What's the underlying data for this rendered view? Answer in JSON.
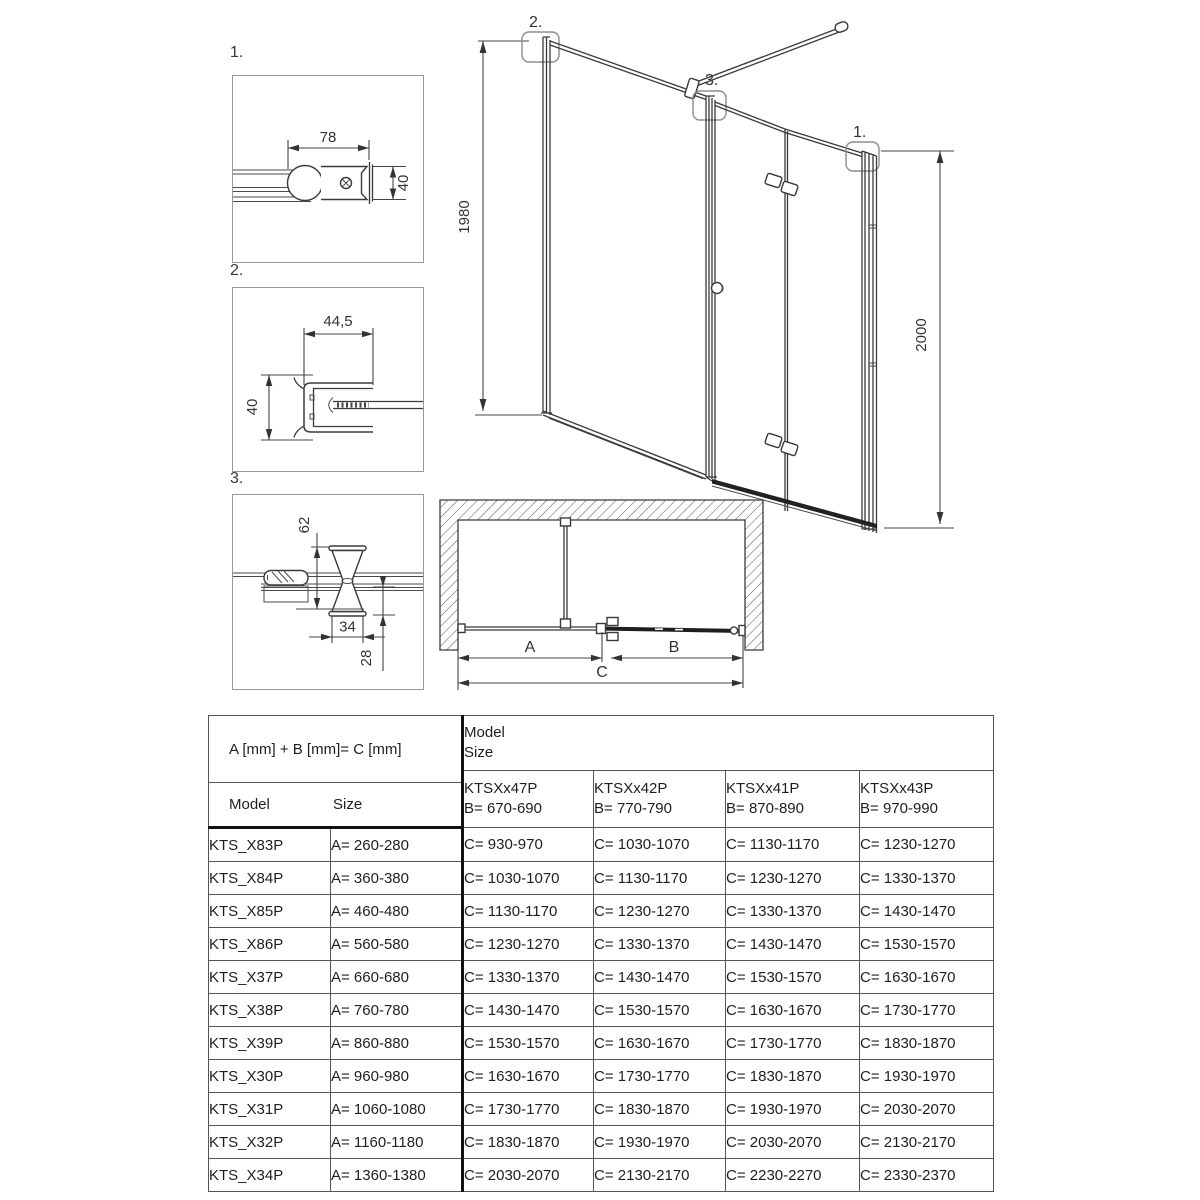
{
  "details": [
    {
      "label": "1.",
      "dim_width": "78",
      "dim_height": "40"
    },
    {
      "label": "2.",
      "dim_width": "44,5",
      "dim_height": "40"
    },
    {
      "label": "3.",
      "dim_top": "62",
      "dim_width": "34",
      "dim_bottom": "28"
    }
  ],
  "elevation": {
    "callout_wall_profile": "2.",
    "callout_center_profile": "3.",
    "callout_right_profile": "1.",
    "dim_height_left": "1980",
    "dim_height_right": "2000"
  },
  "plan": {
    "dim_a": "A",
    "dim_b": "B",
    "dim_c": "C"
  },
  "table": {
    "formula": "A [mm] + B [mm]= C [mm]",
    "col_model": "Model",
    "col_size": "Size",
    "group_line1": "Model",
    "group_line2": "Size",
    "columns": [
      {
        "name": "KTSXx47P",
        "b": "B= 670-690"
      },
      {
        "name": "KTSXx42P",
        "b": "B= 770-790"
      },
      {
        "name": "KTSXx41P",
        "b": "B= 870-890"
      },
      {
        "name": "KTSXx43P",
        "b": "B= 970-990"
      }
    ],
    "rows": [
      {
        "model": "KTS_X83P",
        "a": "A= 260-280",
        "c": [
          "C= 930-970",
          "C= 1030-1070",
          "C= 1130-1170",
          "C= 1230-1270"
        ]
      },
      {
        "model": "KTS_X84P",
        "a": "A= 360-380",
        "c": [
          "C= 1030-1070",
          "C= 1130-1170",
          "C= 1230-1270",
          "C= 1330-1370"
        ]
      },
      {
        "model": "KTS_X85P",
        "a": "A= 460-480",
        "c": [
          "C= 1130-1170",
          "C= 1230-1270",
          "C= 1330-1370",
          "C= 1430-1470"
        ]
      },
      {
        "model": "KTS_X86P",
        "a": "A= 560-580",
        "c": [
          "C= 1230-1270",
          "C= 1330-1370",
          "C= 1430-1470",
          "C= 1530-1570"
        ]
      },
      {
        "model": "KTS_X37P",
        "a": "A= 660-680",
        "c": [
          "C= 1330-1370",
          "C= 1430-1470",
          "C= 1530-1570",
          "C= 1630-1670"
        ]
      },
      {
        "model": "KTS_X38P",
        "a": "A= 760-780",
        "c": [
          "C= 1430-1470",
          "C= 1530-1570",
          "C= 1630-1670",
          "C= 1730-1770"
        ]
      },
      {
        "model": "KTS_X39P",
        "a": "A= 860-880",
        "c": [
          "C= 1530-1570",
          "C= 1630-1670",
          "C= 1730-1770",
          "C= 1830-1870"
        ]
      },
      {
        "model": "KTS_X30P",
        "a": "A= 960-980",
        "c": [
          "C= 1630-1670",
          "C= 1730-1770",
          "C= 1830-1870",
          "C= 1930-1970"
        ]
      },
      {
        "model": "KTS_X31P",
        "a": "A= 1060-1080",
        "c": [
          "C= 1730-1770",
          "C= 1830-1870",
          "C= 1930-1970",
          "C= 2030-2070"
        ]
      },
      {
        "model": "KTS_X32P",
        "a": "A= 1160-1180",
        "c": [
          "C= 1830-1870",
          "C= 1930-1970",
          "C= 2030-2070",
          "C= 2130-2170"
        ]
      },
      {
        "model": "KTS_X34P",
        "a": "A= 1360-1380",
        "c": [
          "C= 2030-2070",
          "C= 2130-2170",
          "C= 2230-2270",
          "C= 2330-2370"
        ]
      }
    ]
  }
}
